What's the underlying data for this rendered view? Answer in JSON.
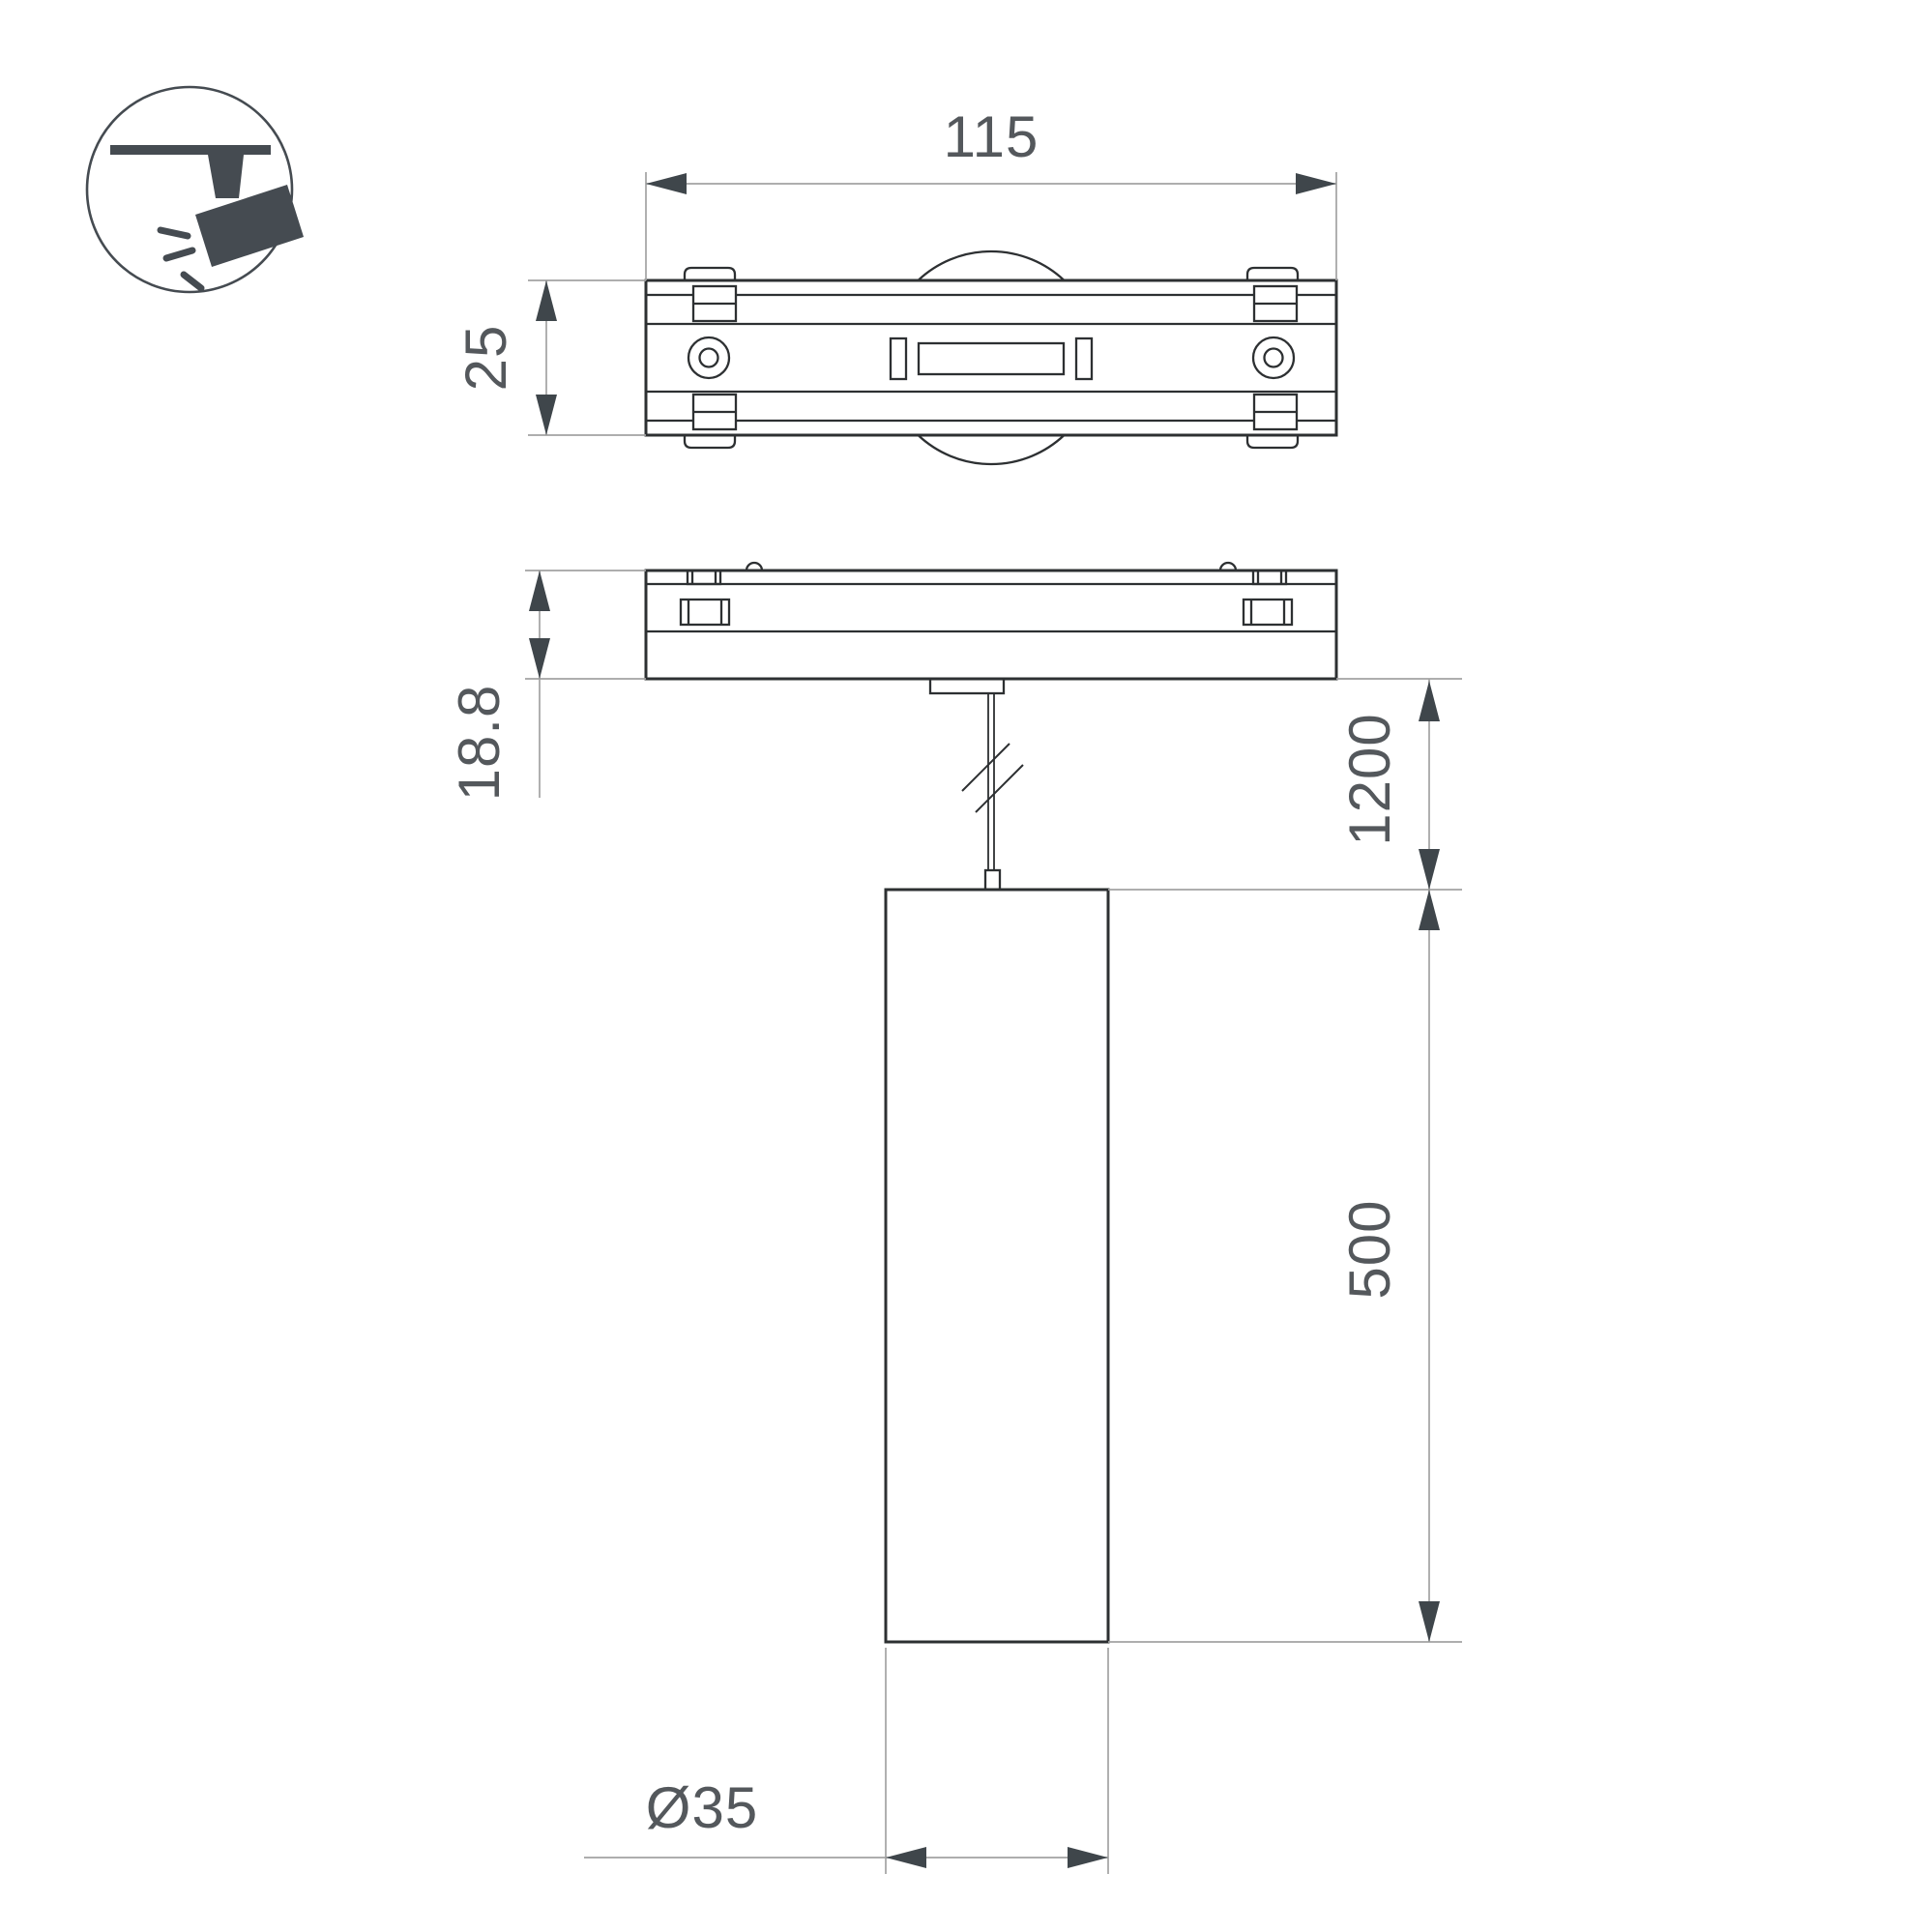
{
  "drawing": {
    "type": "technical-dimension-drawing",
    "subject": "magnetic track pendant spotlight",
    "views": [
      "top-view",
      "side-view-with-pendant"
    ],
    "icon": {
      "name": "track-spotlight-icon",
      "description": "spotlight hanging from track inside circle"
    }
  },
  "labels": {
    "adapter_length": "115",
    "adapter_width": "25",
    "adapter_height": "18.8",
    "suspension_length": "1200",
    "lamp_height": "500",
    "lamp_diameter": "Ø35"
  },
  "colors": {
    "outline": "#2d3032",
    "thin_line": "#a2a2a2",
    "arrow": "#3f464b",
    "text": "#54585c",
    "icon": "#454b51",
    "background": "#ffffff"
  }
}
